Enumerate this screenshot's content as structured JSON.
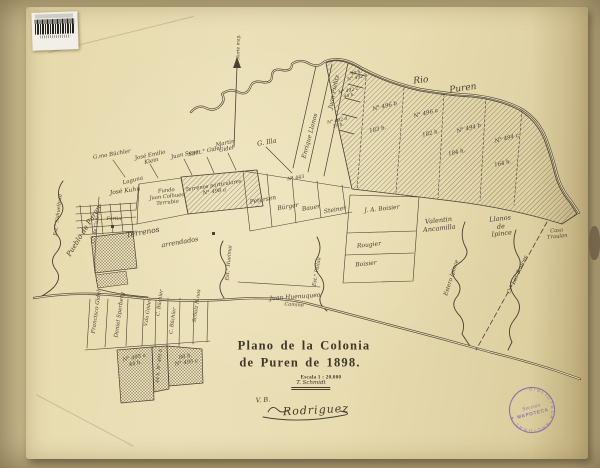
{
  "document": {
    "title_line1": "Plano de la Colonia",
    "title_line2": "de Puren de 1898.",
    "scale_label": "Escala 1 : 20.000",
    "surveyor_signature": "T. Schmidt",
    "approval_initials": "V. B.",
    "approval_signature": "Rodriguez"
  },
  "library_marks": {
    "stamp_ring_text": "BIBLIOTECA NACIONAL ✶",
    "stamp_center_line1": "Sección",
    "stamp_center_line2": "MAPOTECA"
  },
  "palette": {
    "paper": "#e9ddb2",
    "scan_background": "#c9b98c",
    "ink": "#4a4033",
    "stamp_purple": "#7b5da9"
  },
  "map": {
    "labels": [
      {
        "t": "Norte mag.",
        "x": 239,
        "y": 47,
        "r": -90,
        "s": 4.4
      },
      {
        "t": "Rio",
        "x": 421,
        "y": 81,
        "r": -6,
        "s": 9
      },
      {
        "t": "Puren",
        "x": 463,
        "y": 89,
        "r": -8,
        "s": 9
      },
      {
        "t": "N° 496 b",
        "x": 385,
        "y": 107,
        "r": -14,
        "s": 5.5
      },
      {
        "t": "183 h.",
        "x": 378,
        "y": 130,
        "r": -12,
        "s": 5.5
      },
      {
        "t": "N° 496 a",
        "x": 426,
        "y": 114,
        "r": -14,
        "s": 5.5
      },
      {
        "t": "182 h.",
        "x": 431,
        "y": 134,
        "r": -12,
        "s": 5.5
      },
      {
        "t": "N° 494 b",
        "x": 469,
        "y": 129,
        "r": -14,
        "s": 5.5
      },
      {
        "t": "184 h.",
        "x": 457,
        "y": 153,
        "r": -12,
        "s": 5.5
      },
      {
        "t": "N° 494 c",
        "x": 507,
        "y": 139,
        "r": -14,
        "s": 5.5
      },
      {
        "t": "164 h.",
        "x": 503,
        "y": 164,
        "r": -12,
        "s": 5.5
      },
      {
        "t": "40 h.\nN° 492 b",
        "x": 357,
        "y": 76,
        "r": -12,
        "s": 4.5
      },
      {
        "t": "N° 492 c\n44 h.",
        "x": 349,
        "y": 94,
        "r": -12,
        "s": 4.5
      },
      {
        "t": "N° 492 d\n39 h.",
        "x": 338,
        "y": 124,
        "r": -12,
        "s": 4.5
      },
      {
        "t": "Juan Fielitz",
        "x": 334,
        "y": 92,
        "r": -78,
        "s": 6
      },
      {
        "t": "Enrique Llanos",
        "x": 310,
        "y": 136,
        "r": -75,
        "s": 6
      },
      {
        "t": "G. Illa",
        "x": 267,
        "y": 143,
        "r": -10,
        "s": 6.5
      },
      {
        "t": "Martin\nGidel",
        "x": 226,
        "y": 147,
        "r": -12,
        "s": 5.5
      },
      {
        "t": "Sant.° Gidel",
        "x": 205,
        "y": 152,
        "r": -12,
        "s": 5.5
      },
      {
        "t": "Juan Sepe",
        "x": 185,
        "y": 155,
        "r": -12,
        "s": 5.5
      },
      {
        "t": "José Emilio\nKlein",
        "x": 151,
        "y": 159,
        "r": -12,
        "s": 5.5
      },
      {
        "t": "G.mo Büchler",
        "x": 112,
        "y": 155,
        "r": -10,
        "s": 5.5
      },
      {
        "t": "Laguna",
        "x": 133,
        "y": 181,
        "r": -14,
        "s": 5.5
      },
      {
        "t": "José Kuhn",
        "x": 125,
        "y": 191,
        "r": -8,
        "s": 6
      },
      {
        "t": "Fundo\nJuan Colhueo\nTerrubio",
        "x": 167,
        "y": 197,
        "r": -6,
        "s": 5.2
      },
      {
        "t": "Terrenos particulares\nN° 498 a",
        "x": 214,
        "y": 189,
        "r": -9,
        "s": 5.2
      },
      {
        "t": "Pueblo de Puren",
        "x": 84,
        "y": 231,
        "r": -58,
        "s": 7
      },
      {
        "t": "Est.° Nahuelbuta",
        "x": 59,
        "y": 215,
        "r": -83,
        "s": 4.8
      },
      {
        "t": "C.° de Cañete",
        "x": 97,
        "y": 227,
        "r": -80,
        "s": 4.8
      },
      {
        "t": "Fortin",
        "x": 114,
        "y": 220,
        "r": 0,
        "s": 4.8
      },
      {
        "t": "Terrenos",
        "x": 143,
        "y": 233,
        "r": -10,
        "s": 7.5
      },
      {
        "t": "arrendados",
        "x": 180,
        "y": 243,
        "r": -10,
        "s": 6.5
      },
      {
        "t": "Petersen",
        "x": 263,
        "y": 200,
        "r": -10,
        "s": 6
      },
      {
        "t": "Bürger",
        "x": 288,
        "y": 207,
        "r": -10,
        "s": 6
      },
      {
        "t": "Bauer",
        "x": 311,
        "y": 208,
        "r": -10,
        "s": 6
      },
      {
        "t": "Steiner",
        "x": 335,
        "y": 210,
        "r": -10,
        "s": 6
      },
      {
        "t": "N° 443",
        "x": 296,
        "y": 179,
        "r": -10,
        "s": 4.8
      },
      {
        "t": "J. A. Boisier",
        "x": 382,
        "y": 209,
        "r": -6,
        "s": 6
      },
      {
        "t": "Rougier",
        "x": 369,
        "y": 245,
        "r": -6,
        "s": 6
      },
      {
        "t": "Boisier",
        "x": 366,
        "y": 264,
        "r": -6,
        "s": 6
      },
      {
        "t": "Valentin\nAncamilla",
        "x": 439,
        "y": 225,
        "r": -6,
        "s": 6.5
      },
      {
        "t": "Llanos\nde\nIpince",
        "x": 501,
        "y": 227,
        "r": -6,
        "s": 6.5
      },
      {
        "t": "Casa\nTraulen",
        "x": 557,
        "y": 234,
        "r": -6,
        "s": 5.2
      },
      {
        "t": "Estero Ipince",
        "x": 452,
        "y": 278,
        "r": -72,
        "s": 5.5
      },
      {
        "t": "C.° Los Sauces",
        "x": 518,
        "y": 275,
        "r": -65,
        "s": 5.5
      },
      {
        "t": "Est.° Huelmai",
        "x": 230,
        "y": 263,
        "r": -85,
        "s": 5
      },
      {
        "t": "Est.° Pailau",
        "x": 318,
        "y": 272,
        "r": -80,
        "s": 5
      },
      {
        "t": "Juan Huenuqueo",
        "x": 295,
        "y": 297,
        "r": -4,
        "s": 6
      },
      {
        "t": "Camino",
        "x": 294,
        "y": 306,
        "r": 4,
        "s": 5
      },
      {
        "t": "Francisco Gidel",
        "x": 97,
        "y": 312,
        "r": -82,
        "s": 5.5
      },
      {
        "t": "Daniel Sperberg",
        "x": 120,
        "y": 315,
        "r": -82,
        "s": 5.5
      },
      {
        "t": "V.da Gödel",
        "x": 149,
        "y": 313,
        "r": -82,
        "s": 5
      },
      {
        "t": "C. Büchler",
        "x": 161,
        "y": 303,
        "r": -82,
        "s": 5
      },
      {
        "t": "C. Büchler",
        "x": 174,
        "y": 321,
        "r": -82,
        "s": 5
      },
      {
        "t": "Schulz H.nos",
        "x": 198,
        "y": 306,
        "r": -82,
        "s": 5
      },
      {
        "t": "N° 495 a\n44 h.",
        "x": 135,
        "y": 361,
        "r": -12,
        "s": 5.2
      },
      {
        "t": "44 h. N° 495 b",
        "x": 160,
        "y": 366,
        "r": -84,
        "s": 4.6
      },
      {
        "t": "86 h.\nN° 495 c",
        "x": 186,
        "y": 360,
        "r": -8,
        "s": 5.2
      }
    ]
  }
}
